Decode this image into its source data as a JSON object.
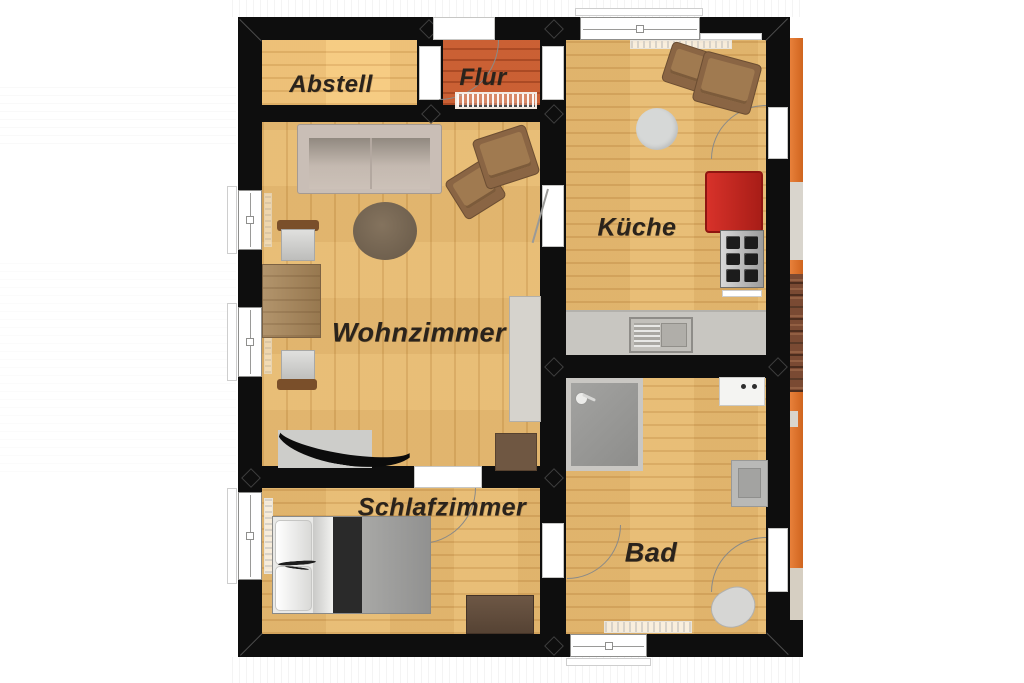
{
  "title": "Apartment floor plan",
  "floorplan": {
    "rooms": {
      "abstell": {
        "label": "Abstell"
      },
      "flur": {
        "label": "Flur"
      },
      "kueche": {
        "label": "Küche"
      },
      "wohnzimmer": {
        "label": "Wohnzimmer"
      },
      "schlafzimmer": {
        "label": "Schlafzimmer"
      },
      "bad": {
        "label": "Bad"
      }
    },
    "furniture": [
      "sofa",
      "armchair",
      "round-rug",
      "dining-table",
      "dining-chair",
      "tv",
      "sideboard",
      "storage-cube",
      "double-bed",
      "dresser",
      "shower",
      "washing-machine",
      "wash-basin",
      "toilet",
      "fridge",
      "stove",
      "kitchen-counter",
      "kitchen-sink",
      "round-table",
      "kitchen-chair",
      "doormat"
    ],
    "colors": {
      "wall": "#0e0e0e",
      "wood_floor": "#e3b46a",
      "flur_floor": "#c2572c",
      "terrace_orange": "#e0762f",
      "brick": "#7a4a33",
      "fridge_red": "#c32524",
      "counter_gray": "#c8c6c1",
      "label_text": "#2a231c"
    }
  }
}
